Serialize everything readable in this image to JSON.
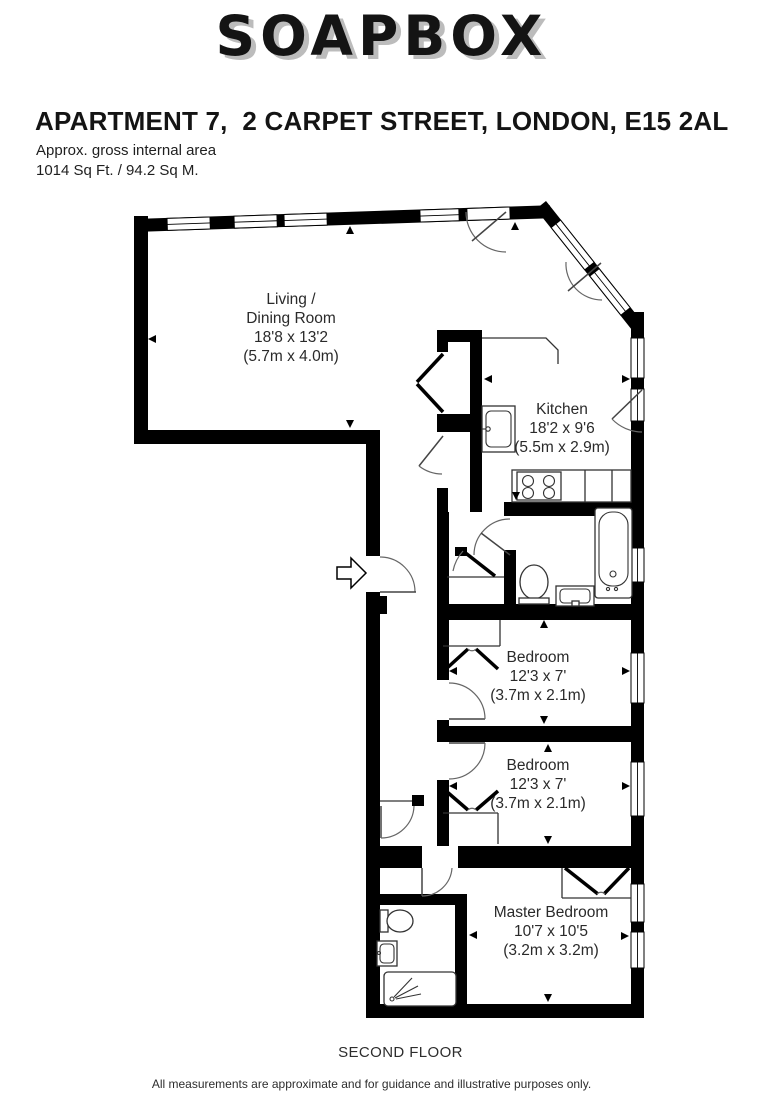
{
  "brand": {
    "logo": "SOAPBOX"
  },
  "header": {
    "title": "APARTMENT 7,  2 CARPET STREET, LONDON, E15 2AL",
    "area_label": "Approx. gross internal area",
    "area_value": "1014 Sq Ft. / 94.2 Sq M."
  },
  "rooms": {
    "living": {
      "name_line1": "Living /",
      "name_line2": "Dining Room",
      "dims": "18'8 x 13'2",
      "metric": "(5.7m x 4.0m)"
    },
    "kitchen": {
      "name": "Kitchen",
      "dims": "18'2 x 9'6",
      "metric": "(5.5m x 2.9m)"
    },
    "bedroom1": {
      "name": "Bedroom",
      "dims": "12'3 x 7'",
      "metric": "(3.7m x 2.1m)"
    },
    "bedroom2": {
      "name": "Bedroom",
      "dims": "12'3 x 7'",
      "metric": "(3.7m x 2.1m)"
    },
    "master": {
      "name": "Master Bedroom",
      "dims": "10'7 x 10'5",
      "metric": "(3.2m x 3.2m)"
    }
  },
  "footer": {
    "floor": "SECOND FLOOR",
    "disclaimer": "All measurements are approximate and for guidance and illustrative purposes only."
  }
}
